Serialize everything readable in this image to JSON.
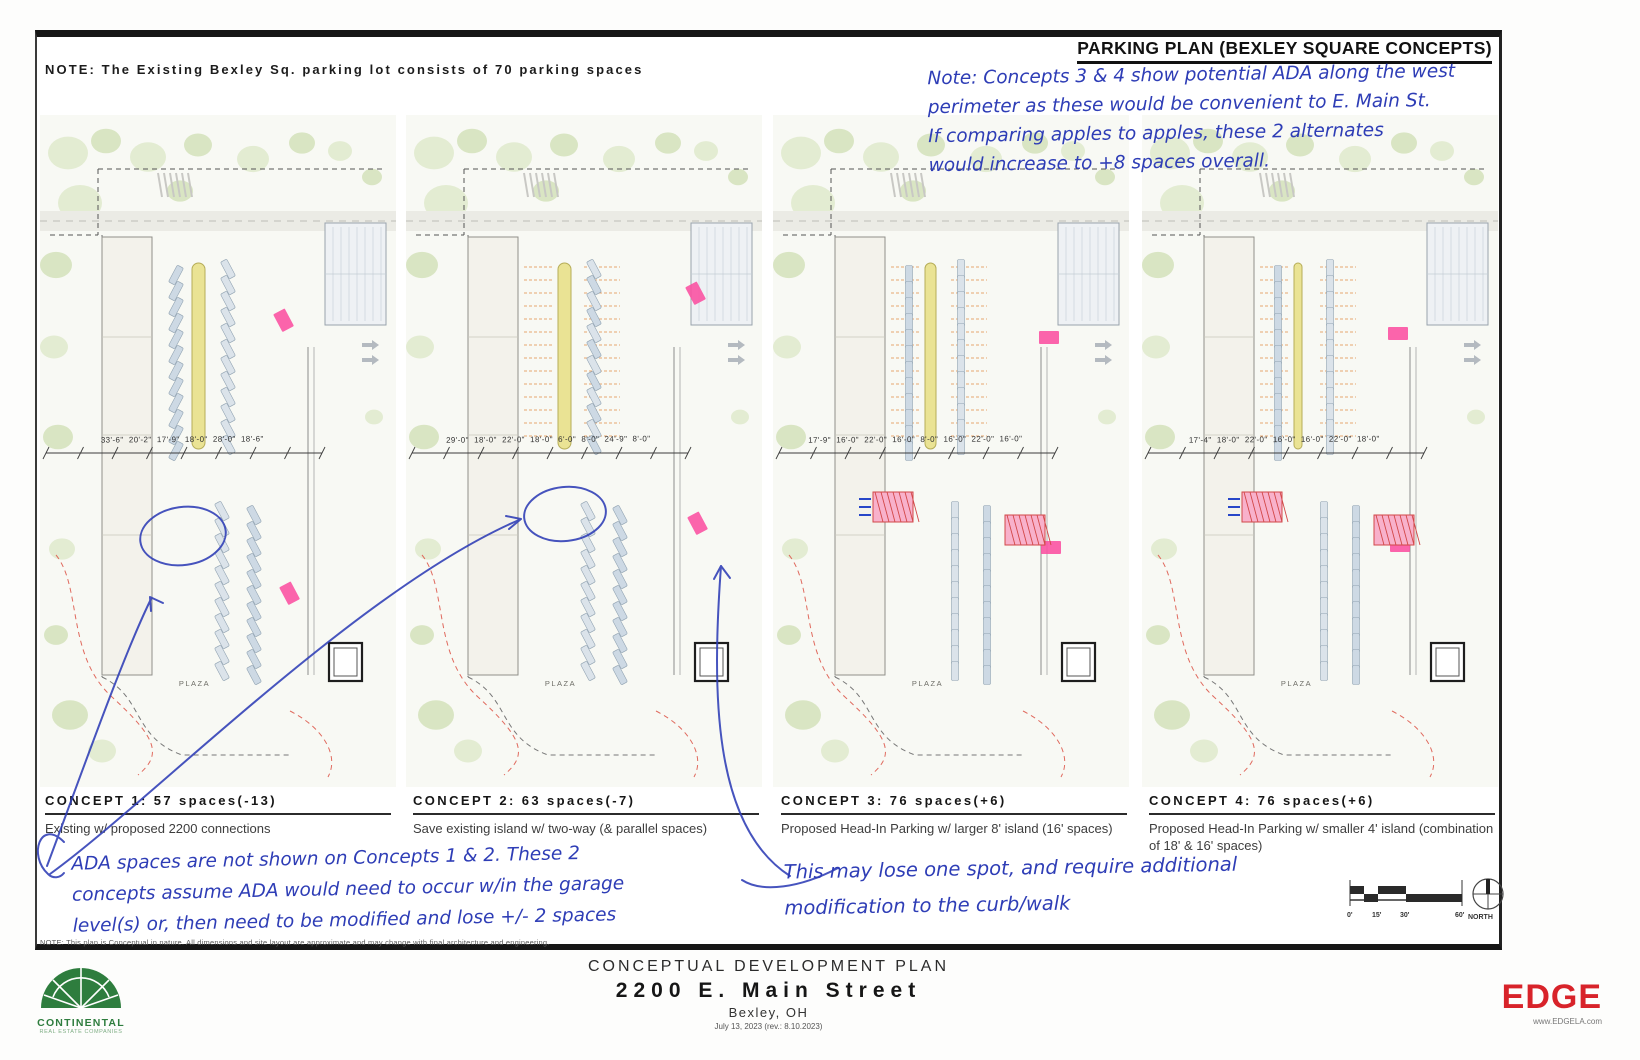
{
  "sheet": {
    "top_note": "NOTE: The Existing Bexley Sq. parking lot consists of 70 parking spaces",
    "title": "PARKING PLAN (BEXLEY SQUARE CONCEPTS)",
    "disclaimer": "NOTE: This plan is Conceptual in nature. All dimensions and site layout are approximate and may change with final architecture and engineering."
  },
  "handwritten": {
    "ink_color": "#2e3db6",
    "top_right": [
      "Note: Concepts 3 & 4 show potential ADA along the west",
      "perimeter as these would be convenient to E. Main St.",
      "If comparing apples to apples, these 2 alternates",
      "would increase to +8 spaces overall."
    ],
    "bottom_left": [
      "ADA spaces are not shown on Concepts 1 & 2. These 2",
      "concepts assume ADA would need to occur w/in the garage",
      "level(s) or, then need to be modified and lose +/- 2 spaces"
    ],
    "bottom_middle": [
      "This may lose one spot, and require additional",
      "modification to the curb/walk"
    ]
  },
  "concepts": [
    {
      "title": "CONCEPT 1: 57 spaces(-13)",
      "subtitle": "Existing w/ proposed 2200 connections",
      "dimensions": [
        "33'-6\"",
        "20'-2\"",
        "17'-9\"",
        "18'-0\"",
        "28'-0\"",
        "18'-6\""
      ],
      "plaza_label": "PLAZA"
    },
    {
      "title": "CONCEPT 2: 63 spaces(-7)",
      "subtitle": "Save existing island w/ two-way (& parallel spaces)",
      "dimensions": [
        "29'-0\"",
        "18'-0\"",
        "22'-0\"",
        "18'-0\"",
        "6'-0\"",
        "8'-0\"",
        "24'-9\"",
        "8'-0\""
      ],
      "plaza_label": "PLAZA"
    },
    {
      "title": "CONCEPT 3: 76 spaces(+6)",
      "subtitle": "Proposed Head-In Parking w/ larger 8' island (16' spaces)",
      "dimensions": [
        "17'-9\"",
        "16'-0\"",
        "22'-0\"",
        "16'-0\"",
        "8'-0\"",
        "16'-0\"",
        "22'-0\"",
        "16'-0\""
      ],
      "plaza_label": "PLAZA"
    },
    {
      "title": "CONCEPT 4: 76 spaces(+6)",
      "subtitle": "Proposed Head-In Parking w/ smaller 4' island (combination of 18' & 16' spaces)",
      "dimensions": [
        "17'-4\"",
        "18'-0\"",
        "22'-0\"",
        "16'-0\"",
        "16'-0\"",
        "22'-0\"",
        "18'-0\""
      ],
      "plaza_label": "PLAZA"
    }
  ],
  "title_block": {
    "line1": "CONCEPTUAL DEVELOPMENT PLAN",
    "line2": "2200 E. Main Street",
    "line3": "Bexley, OH",
    "line4": "July 13, 2023 (rev.: 8.10.2023)"
  },
  "logos": {
    "continental": {
      "name": "CONTINENTAL",
      "tagline": "REAL ESTATE COMPANIES",
      "color": "#2e7d3e"
    },
    "edge": {
      "name": "EDGE",
      "url": "www.EDGELA.com",
      "color": "#d8232a"
    }
  },
  "scale_bar": {
    "ticks": [
      "0'",
      "15'",
      "30'",
      "60'"
    ],
    "north_label": "NORTH"
  }
}
